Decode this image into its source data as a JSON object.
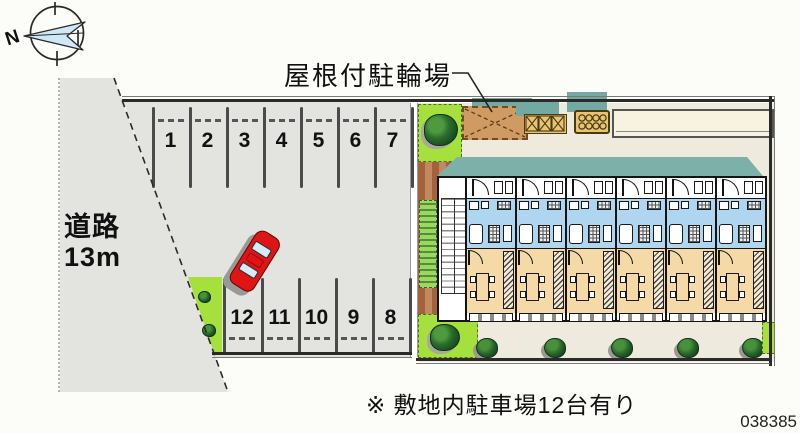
{
  "plan": {
    "id_number": "038385",
    "note": "※ 敷地内駐車場12台有り",
    "bicycle_parking_label": "屋根付駐輪場",
    "road_label": "道路",
    "road_width": "13m",
    "compass_north": "N"
  },
  "parking": {
    "top_row_numbers": [
      "1",
      "2",
      "3",
      "4",
      "5",
      "6",
      "7"
    ],
    "bottom_row_numbers": [
      "12",
      "11",
      "10",
      "9",
      "8"
    ]
  },
  "building": {
    "unit_count": 6
  },
  "colors": {
    "site_gray": "#e3e3e0",
    "grass_green": "#a6e03c",
    "brick_brown": "#b5714a",
    "shed_tan": "#cf9b62",
    "box_tan": "#e6c473",
    "shadow_teal": "#74a8a2",
    "roof_teal": "#7cb0a8",
    "walkway_cream": "#f8f3e1",
    "unit_blue": "#aed6f0",
    "unit_orange": "#f5d9a6",
    "car_red": "#df1414"
  }
}
